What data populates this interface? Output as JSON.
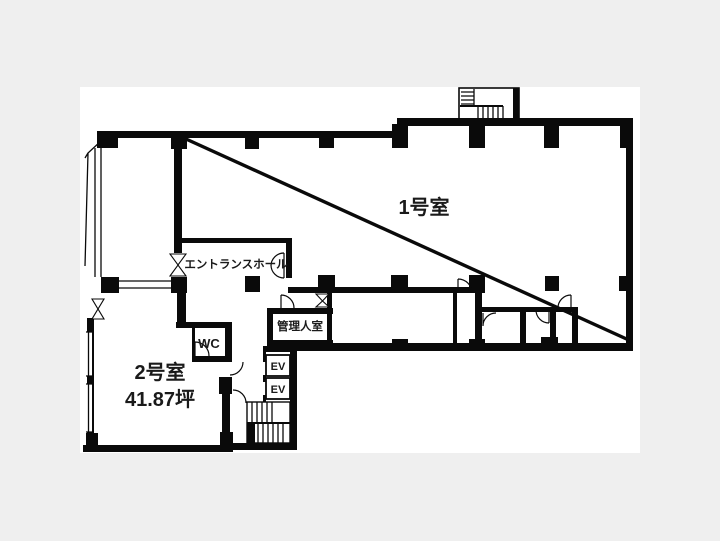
{
  "floorplan": {
    "colors": {
      "background": "#efefef",
      "canvas": "#ffffff",
      "wall": "#0a0a0a",
      "text": "#1a1a1a"
    },
    "labels": {
      "room1": "1号室",
      "entrance_hall": "エントランスホール",
      "manager_room": "管理人室",
      "wc": "WC",
      "elevator_1": "EV",
      "elevator_2": "EV",
      "room2": "2号室",
      "room2_area": "41.87坪"
    }
  }
}
